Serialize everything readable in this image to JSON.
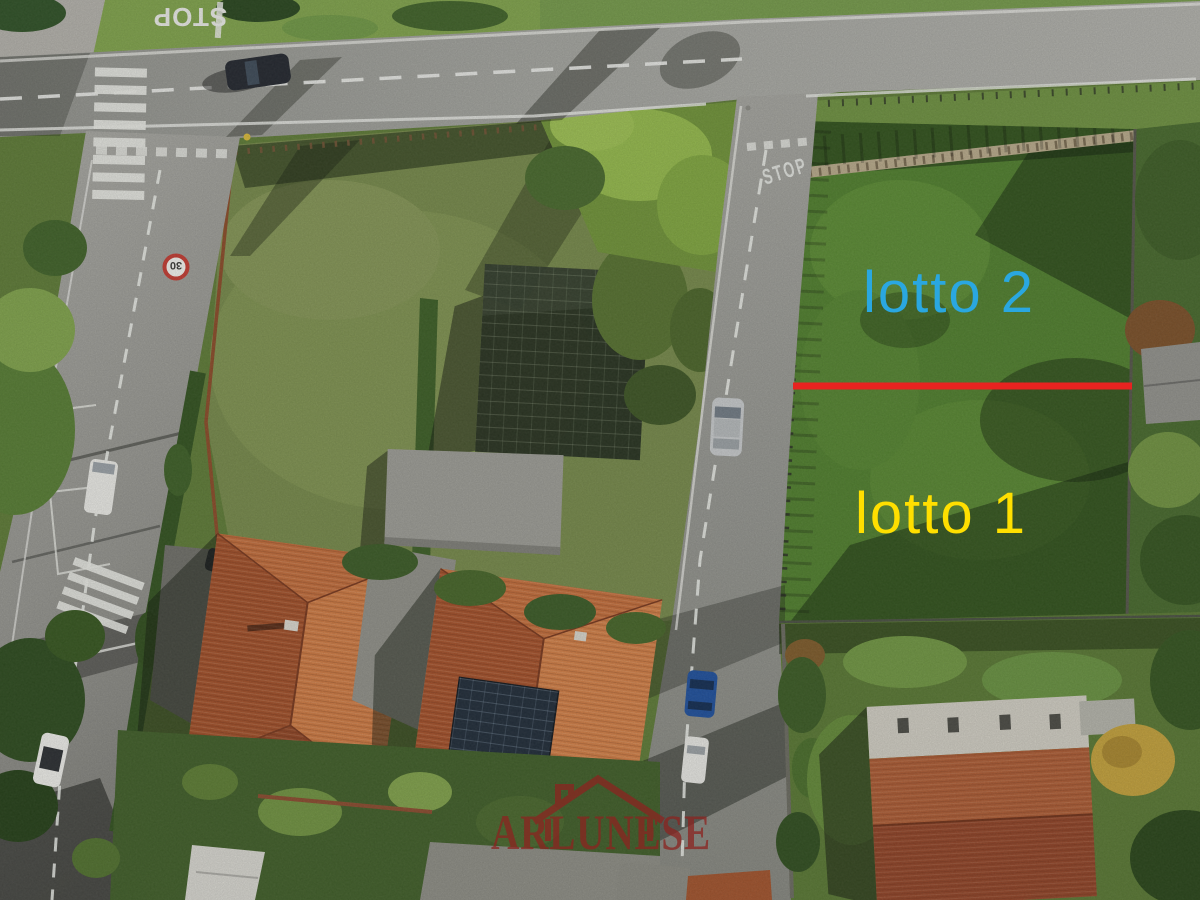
{
  "annotations": {
    "lot2": {
      "label": "lotto 2",
      "color": "#2aa7e0"
    },
    "lot1": {
      "label": "lotto 1",
      "color": "#ffdf00"
    },
    "divider": {
      "color": "#e82320"
    }
  },
  "watermark": {
    "text": "ARLUNESE",
    "color": "#8b2420",
    "icon": "house-outline-icon"
  },
  "road_markings": {
    "stop_main": "STOP",
    "stop_side": "STOP",
    "speed_limit": "30"
  }
}
